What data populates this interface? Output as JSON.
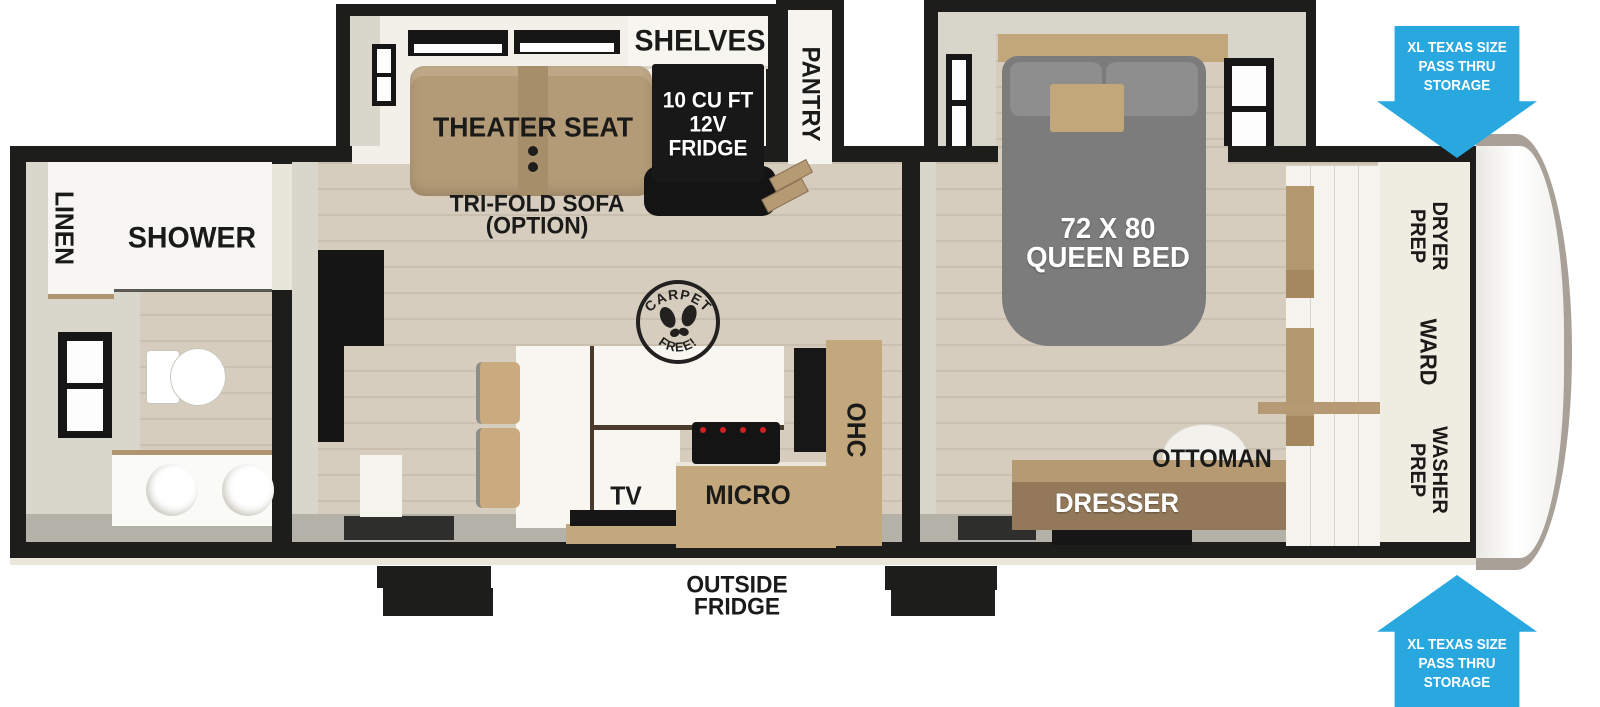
{
  "colors": {
    "wall": "#1d1d1b",
    "arrow_blue": "#29a8e0",
    "wood_floor": "#d6cdbe",
    "cabinet_wood": "#c4a87d",
    "seat_tan": "#b49b77",
    "bed_gray": "#7c7c7c"
  },
  "bathroom": {
    "linen": "LINEN",
    "shower": "SHOWER"
  },
  "living": {
    "theater_seat": "THEATER SEAT",
    "tri_fold_line1": "TRI-FOLD SOFA",
    "tri_fold_line2": "(OPTION)",
    "shelves": "SHELVES",
    "pantry": "PANTRY",
    "fridge_line1": "10 CU FT",
    "fridge_line2": "12V",
    "fridge_line3": "FRIDGE",
    "stamp_top": "CARPET",
    "stamp_bottom": "FREE!",
    "tv": "TV",
    "micro": "MICRO",
    "ohc": "OHC",
    "outside_fridge_line1": "OUTSIDE",
    "outside_fridge_line2": "FRIDGE"
  },
  "bedroom": {
    "bed_line1": "72 X 80",
    "bed_line2": "QUEEN BED",
    "dresser": "DRESSER",
    "ottoman": "OTTOMAN",
    "dryer_line1": "DRYER",
    "dryer_line2": "PREP",
    "ward": "WARD",
    "washer_line1": "WASHER",
    "washer_line2": "PREP"
  },
  "callouts": {
    "top": {
      "line1": "XL TEXAS SIZE",
      "line2": "PASS THRU",
      "line3": "STORAGE"
    },
    "bottom": {
      "line1": "XL TEXAS SIZE",
      "line2": "PASS THRU",
      "line3": "STORAGE"
    }
  }
}
